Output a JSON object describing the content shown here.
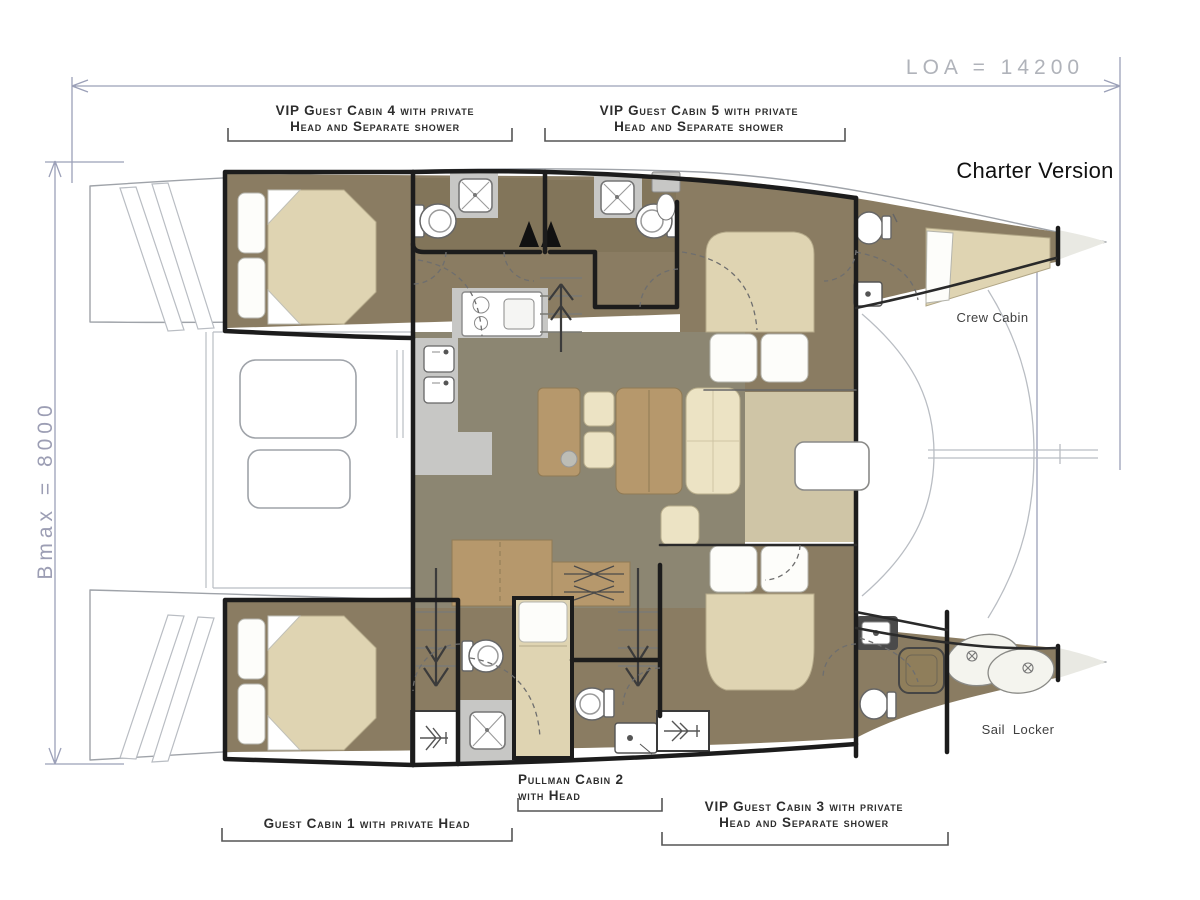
{
  "annotations": {
    "charter_version": "Charter Version",
    "loa": "LOA = 14200",
    "bmax": "Bmax = 8000",
    "crew_cabin": "Crew Cabin",
    "sail_locker": "Sail Locker"
  },
  "cabin_labels": {
    "vip4_line1": "VIP Guest Cabin 4 with private",
    "vip4_line2": "Head and Separate shower",
    "vip5_line1": "VIP Guest Cabin 5 with private",
    "vip5_line2": "Head and Separate shower",
    "guest1": "Guest Cabin 1 with private Head",
    "pullman2_line1": "Pullman Cabin 2",
    "pullman2_line2": "with Head",
    "vip3_line1": "VIP Guest Cabin 3 with private",
    "vip3_line2": "Head and Separate shower"
  },
  "colors": {
    "floor-olive": "#8C8672",
    "hull-brown": "#8A7C62",
    "head-brown": "#82755A",
    "bed-beige": "#DFD4B2",
    "pale-beige": "#CFC5A6",
    "furniture-tan": "#B6986C",
    "seat-cream": "#ECE3C4",
    "galley-gray": "#C7C7C5",
    "wall-black": "#1C1C1C",
    "outline-gray": "#9FA3A9",
    "deck-line": "#B9BDC3",
    "bow-fill": "#E9E9E3",
    "dim-line": "#9BA0B8",
    "loa-text": "#B0B3BA",
    "bmax-text": "#9C9EB4",
    "label-text": "#2D2D2D",
    "area-text": "#3F3F3F",
    "title-text": "#101010"
  }
}
